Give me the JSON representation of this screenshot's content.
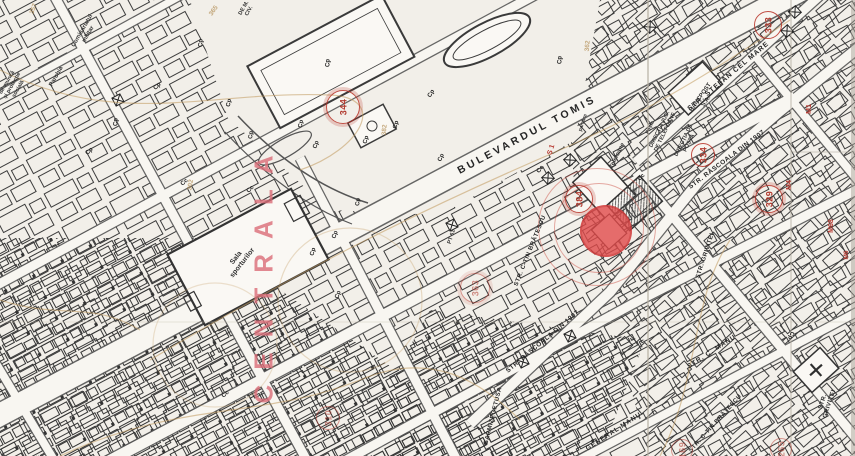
{
  "map": {
    "title": "cadastral-plan-scan",
    "colors": {
      "paper": "#f2efe9",
      "ink": "#3a3a3a",
      "red_annotation": "#b73b32",
      "highlight_dot": "#e04949",
      "ochre_utility": "#b08a4f",
      "pink_overprint": "#db6d78"
    },
    "highlight": {
      "x": 606,
      "y": 231,
      "radius": 26,
      "rings": [
        {
          "x": 598,
          "y": 227,
          "r": 44
        },
        {
          "x": 596,
          "y": 226,
          "r": 58
        }
      ]
    },
    "big_text": {
      "name": "overprint-centrala",
      "text": "CENTRALA",
      "x": 264,
      "y": 272,
      "rot": -90,
      "cls": "centrala",
      "size": 26
    },
    "labels": [
      {
        "name": "street-bulevardul-tomis",
        "text": "BULEVARDUL  TOMIS",
        "x": 527,
        "y": 135,
        "rot": -28,
        "cls": "st",
        "size": 10.5,
        "ls": 3
      },
      {
        "name": "street-stefan-cel-mare",
        "text": "STR. ȘTEFAN CEL MARE",
        "x": 729,
        "y": 77,
        "rot": -40,
        "cls": "st",
        "size": 7,
        "ls": 1
      },
      {
        "name": "street-rascoala-1907-north",
        "text": "STR. RĂSCOALA DIN 1907",
        "x": 727,
        "y": 160,
        "rot": -37,
        "cls": "st",
        "size": 6.5,
        "ls": 0.5
      },
      {
        "name": "street-rascoala-1907-south",
        "text": "STR. RĂSCOALA DIN 1907",
        "x": 543,
        "y": 342,
        "rot": -40,
        "cls": "st",
        "size": 6.5,
        "ls": 0.5
      },
      {
        "name": "street-ctin-bratescu-west",
        "text": "STR. C-TIN BRĂTESCU",
        "x": 531,
        "y": 251,
        "rot": -68,
        "cls": "st",
        "size": 6,
        "ls": 0.5
      },
      {
        "name": "street-ctin-bratescu-south",
        "text": "STR. C-TIN BRĂTESCU",
        "x": 716,
        "y": 424,
        "rot": -48,
        "cls": "st",
        "size": 6,
        "ls": 0.5
      },
      {
        "name": "street-c-manu",
        "text": "STR. C. MANU",
        "x": 712,
        "y": 352,
        "rot": -33,
        "cls": "st",
        "size": 6.5,
        "ls": 1
      },
      {
        "name": "street-grivitei-north",
        "text": "STR. GRIVIȚEI",
        "x": 706,
        "y": 256,
        "rot": -72,
        "cls": "st",
        "size": 6,
        "ls": 0.5
      },
      {
        "name": "street-grivitei-south",
        "text": "STR. GRIVIȚEI",
        "x": 827,
        "y": 403,
        "rot": -72,
        "cls": "st",
        "size": 6,
        "ls": 0.5
      },
      {
        "name": "street-general-manu",
        "text": "GENERAL MANU",
        "x": 614,
        "y": 432,
        "rot": -33,
        "cls": "st",
        "size": 6.5,
        "ls": 1
      },
      {
        "name": "street-sarmizegetusa",
        "text": "SARMIZEGETUSA",
        "x": 494,
        "y": 416,
        "rot": -76,
        "cls": "st",
        "size": 6,
        "ls": 0.5
      },
      {
        "name": "place-sala-sporturilor",
        "text": "Sala\nsporturilor",
        "x": 240,
        "y": 261,
        "rot": -52,
        "cls": "pl",
        "size": 7
      },
      {
        "name": "place-telefoane",
        "text": "Telefoane",
        "x": 618,
        "y": 156,
        "rot": -64,
        "cls": "pl",
        "size": 6
      },
      {
        "name": "place-directia-telefoane",
        "text": "DIRECȚIA JUD.\nDE TELEFOANE",
        "x": 663,
        "y": 131,
        "rot": -64,
        "cls": "pl",
        "size": 5.5
      },
      {
        "name": "place-directia-posta",
        "text": "DIRECȚIA DE\nPOȘTĂ",
        "x": 687,
        "y": 142,
        "rot": -64,
        "cls": "pl",
        "size": 5.5
      },
      {
        "name": "place-posta",
        "text": "Poșta",
        "x": 651,
        "y": 128,
        "rot": -64,
        "cls": "pl",
        "size": 5
      },
      {
        "name": "place-bancpost",
        "text": "BANCPOST\nS.A.",
        "x": 704,
        "y": 100,
        "rot": -55,
        "cls": "pl",
        "size": 6
      },
      {
        "name": "place-comisariatul-militar",
        "text": "Comisariatul\nmilitar",
        "x": 86,
        "y": 33,
        "rot": -60,
        "cls": "pl",
        "size": 6
      },
      {
        "name": "place-parohia",
        "text": "Parohia",
        "x": 57,
        "y": 77,
        "rot": -60,
        "cls": "pl",
        "size": 6
      },
      {
        "name": "place-protectie-sociala",
        "text": "de muncă\nși protecție\nsocială",
        "x": 13,
        "y": 86,
        "rot": -60,
        "cls": "pl",
        "size": 5.5
      },
      {
        "name": "place-aparare-civila",
        "text": "DE M.\nCIV.",
        "x": 247,
        "y": 10,
        "rot": -60,
        "cls": "pl",
        "size": 5.5
      },
      {
        "name": "place-parcare",
        "text": "parcare",
        "x": 584,
        "y": 123,
        "rot": -72,
        "cls": "pl",
        "size": 5
      },
      {
        "name": "place-pt61",
        "text": "PT 61",
        "x": 452,
        "y": 237,
        "rot": -72,
        "cls": "pl",
        "size": 5.5
      },
      {
        "name": "red-label-s1",
        "text": "S 1",
        "x": 552,
        "y": 150,
        "rot": -72,
        "cls": "red",
        "size": 7
      },
      {
        "name": "red-label-m1",
        "text": "M1",
        "x": 810,
        "y": 109,
        "rot": -90,
        "cls": "red",
        "size": 7
      },
      {
        "name": "red-label-m4",
        "text": "M4",
        "x": 790,
        "y": 185,
        "rot": -90,
        "cls": "red",
        "size": 7
      },
      {
        "name": "red-label-m68",
        "text": "M68",
        "x": 832,
        "y": 226,
        "rot": -90,
        "cls": "red",
        "size": 7
      },
      {
        "name": "red-label-m6",
        "text": "M6",
        "x": 847,
        "y": 255,
        "rot": -90,
        "cls": "red",
        "size": 6.5
      },
      {
        "name": "utility-number-357",
        "text": "357",
        "x": 34,
        "y": 9,
        "rot": -70,
        "cls": "och",
        "size": 6.5
      },
      {
        "name": "utility-number-365",
        "text": "365",
        "x": 214,
        "y": 11,
        "rot": -55,
        "cls": "och",
        "size": 6.5
      },
      {
        "name": "utility-number-382",
        "text": "382",
        "x": 385,
        "y": 130,
        "rot": -85,
        "cls": "och",
        "size": 6.5
      },
      {
        "name": "utility-number-362",
        "text": "362",
        "x": 588,
        "y": 46,
        "rot": -85,
        "cls": "och",
        "size": 6.5
      },
      {
        "name": "utility-number-302",
        "text": "302",
        "x": 191,
        "y": 185,
        "rot": -80,
        "cls": "och",
        "size": 6.5
      },
      {
        "name": "marker-cp",
        "text": "Cp",
        "x": 202,
        "y": 43,
        "rot": -90,
        "cls": "mk",
        "size": 6
      },
      {
        "name": "marker-cp",
        "text": "Cp",
        "x": 158,
        "y": 87,
        "rot": -45,
        "cls": "mk",
        "size": 6
      },
      {
        "name": "marker-cp",
        "text": "Cp",
        "x": 117,
        "y": 122,
        "rot": -90,
        "cls": "mk",
        "size": 6
      },
      {
        "name": "marker-cp",
        "text": "Cp",
        "x": 90,
        "y": 152,
        "rot": -45,
        "cls": "mk",
        "size": 6
      },
      {
        "name": "marker-cp",
        "text": "Cp",
        "x": 230,
        "y": 103,
        "rot": -80,
        "cls": "mk",
        "size": 6
      },
      {
        "name": "marker-cp",
        "text": "Cp",
        "x": 252,
        "y": 135,
        "rot": -85,
        "cls": "mk",
        "size": 6
      },
      {
        "name": "marker-cp",
        "text": "Cp",
        "x": 329,
        "y": 63,
        "rot": -90,
        "cls": "mk",
        "size": 6
      },
      {
        "name": "marker-cp",
        "text": "Cp",
        "x": 432,
        "y": 94,
        "rot": -60,
        "cls": "mk",
        "size": 6
      },
      {
        "name": "marker-cp",
        "text": "Cp",
        "x": 397,
        "y": 125,
        "rot": -75,
        "cls": "mk",
        "size": 6
      },
      {
        "name": "marker-cp",
        "text": "Cp",
        "x": 302,
        "y": 124,
        "rot": -80,
        "cls": "mk",
        "size": 6
      },
      {
        "name": "marker-cp",
        "text": "Cp",
        "x": 317,
        "y": 145,
        "rot": -70,
        "cls": "mk",
        "size": 6
      },
      {
        "name": "marker-cp",
        "text": "Cp",
        "x": 367,
        "y": 140,
        "rot": -75,
        "cls": "mk",
        "size": 6
      },
      {
        "name": "marker-cp",
        "text": "Cp",
        "x": 442,
        "y": 158,
        "rot": -65,
        "cls": "mk",
        "size": 6
      },
      {
        "name": "marker-cp",
        "text": "Cp",
        "x": 359,
        "y": 202,
        "rot": -85,
        "cls": "mk",
        "size": 6
      },
      {
        "name": "marker-cp",
        "text": "Cp",
        "x": 336,
        "y": 235,
        "rot": -70,
        "cls": "mk",
        "size": 6
      },
      {
        "name": "marker-cp",
        "text": "Cp",
        "x": 314,
        "y": 252,
        "rot": -75,
        "cls": "mk",
        "size": 6
      },
      {
        "name": "marker-cp",
        "text": "Cp",
        "x": 339,
        "y": 295,
        "rot": -70,
        "cls": "mk",
        "size": 6
      },
      {
        "name": "marker-cp",
        "text": "Cp",
        "x": 561,
        "y": 60,
        "rot": -90,
        "cls": "mk",
        "size": 6
      },
      {
        "name": "marker-cp",
        "text": "Cp",
        "x": 790,
        "y": 335,
        "rot": 115,
        "cls": "mk",
        "size": 6
      },
      {
        "name": "marker-cc",
        "text": "Cc",
        "x": 251,
        "y": 190,
        "rot": -45,
        "cls": "mk",
        "size": 6
      },
      {
        "name": "marker-cc",
        "text": "Cc",
        "x": 185,
        "y": 183,
        "rot": -40,
        "cls": "mk",
        "size": 6
      },
      {
        "name": "marker-cc",
        "text": "Cc",
        "x": 642,
        "y": 178,
        "rot": -45,
        "cls": "mk",
        "size": 6
      },
      {
        "name": "marker-cc",
        "text": "Cc",
        "x": 541,
        "y": 170,
        "rot": -50,
        "cls": "mk",
        "size": 6
      },
      {
        "name": "marker-cc",
        "text": "Cc",
        "x": 226,
        "y": 395,
        "rot": -40,
        "cls": "mk",
        "size": 6
      }
    ],
    "circled_numbers": [
      {
        "name": "circled-number-344",
        "n": "344",
        "x": 342,
        "y": 106,
        "r": 16,
        "double": true
      },
      {
        "name": "circled-number-384",
        "n": "384",
        "x": 578,
        "y": 198,
        "r": 13,
        "double": true
      },
      {
        "name": "circled-number-334",
        "n": "334",
        "x": 702,
        "y": 154,
        "r": 11
      },
      {
        "name": "circled-number-333",
        "n": "333",
        "x": 767,
        "y": 24,
        "r": 13
      },
      {
        "name": "circled-number-329",
        "n": "329",
        "x": 768,
        "y": 198,
        "r": 13,
        "double": true
      },
      {
        "name": "circled-number-363",
        "n": "363",
        "x": 474,
        "y": 287,
        "r": 14,
        "double": true,
        "faint": true
      },
      {
        "name": "circled-number-310",
        "n": "310",
        "x": 327,
        "y": 417,
        "r": 11,
        "faint": true
      },
      {
        "name": "circled-number-169",
        "n": "169",
        "x": 681,
        "y": 449,
        "r": 10,
        "faint": true
      },
      {
        "name": "circled-number-265",
        "n": "265",
        "x": 780,
        "y": 448,
        "r": 10,
        "faint": true
      }
    ]
  }
}
